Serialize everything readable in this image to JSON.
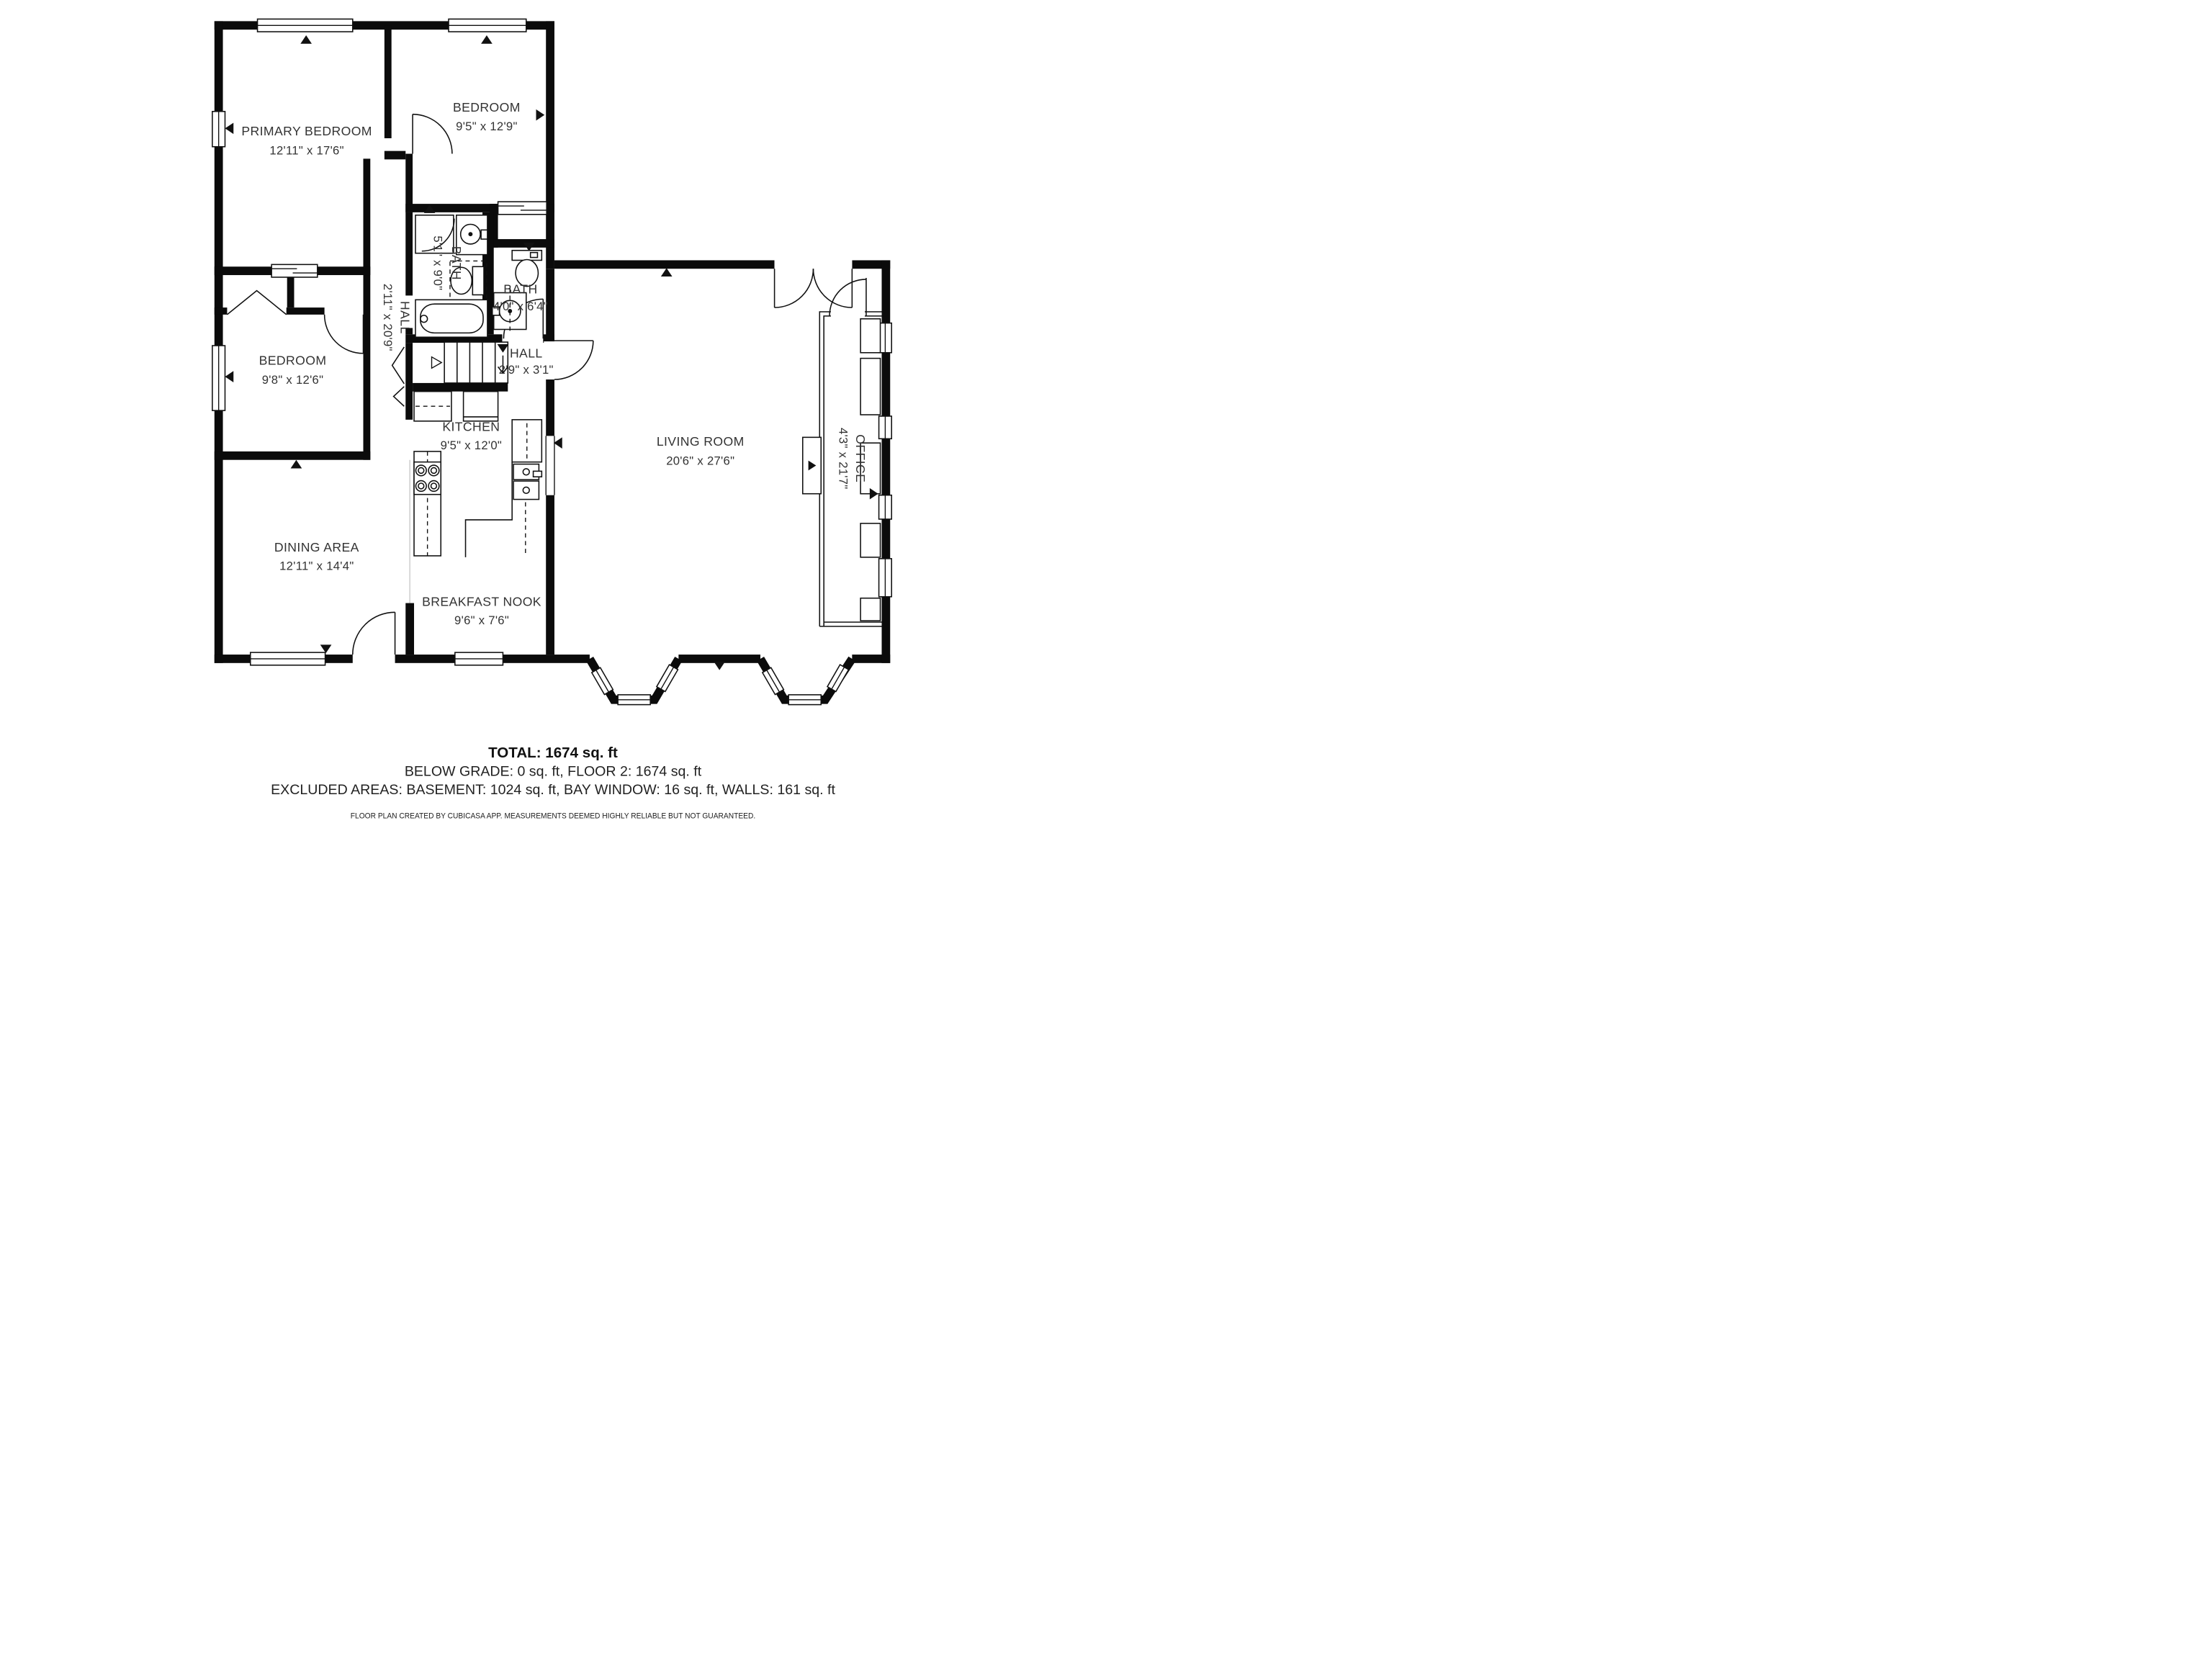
{
  "title": "Floor plan",
  "colors": {
    "wall": "#0b0b0b",
    "text": "#333333",
    "background": "#ffffff"
  },
  "rooms": {
    "primary": {
      "name": "PRIMARY BEDROOM",
      "dims": "12'11\" x 17'6\""
    },
    "bedroom_top": {
      "name": "BEDROOM",
      "dims": "9'5\" x 12'9\""
    },
    "bath1": {
      "name": "BATH",
      "dims": "5'1\" x 9'0\""
    },
    "bath2": {
      "name": "BATH",
      "dims": "4'0\" x 6'4\""
    },
    "hall_long": {
      "name": "HALL",
      "dims": "2'11\" x 20'9\""
    },
    "hall_small": {
      "name": "HALL",
      "dims": "2'9\" x 3'1\""
    },
    "bedroom_left": {
      "name": "BEDROOM",
      "dims": "9'8\" x 12'6\""
    },
    "kitchen": {
      "name": "KITCHEN",
      "dims": "9'5\" x 12'0\""
    },
    "living": {
      "name": "LIVING ROOM",
      "dims": "20'6\" x 27'6\""
    },
    "office": {
      "name": "OFFICE",
      "dims": "4'3\" x 21'7\""
    },
    "dining": {
      "name": "DINING AREA",
      "dims": "12'11\" x 14'4\""
    },
    "breakfast": {
      "name": "BREAKFAST NOOK",
      "dims": "9'6\" x 7'6\""
    }
  },
  "summary": {
    "total": "TOTAL: 1674 sq. ft",
    "line2": "BELOW GRADE: 0 sq. ft, FLOOR 2: 1674 sq. ft",
    "line3": "EXCLUDED AREAS: BASEMENT: 1024 sq. ft, BAY WINDOW: 16 sq. ft, WALLS: 161 sq. ft",
    "disclaimer": "FLOOR PLAN CREATED BY CUBICASA APP. MEASUREMENTS DEEMED HIGHLY RELIABLE BUT NOT GUARANTEED."
  }
}
